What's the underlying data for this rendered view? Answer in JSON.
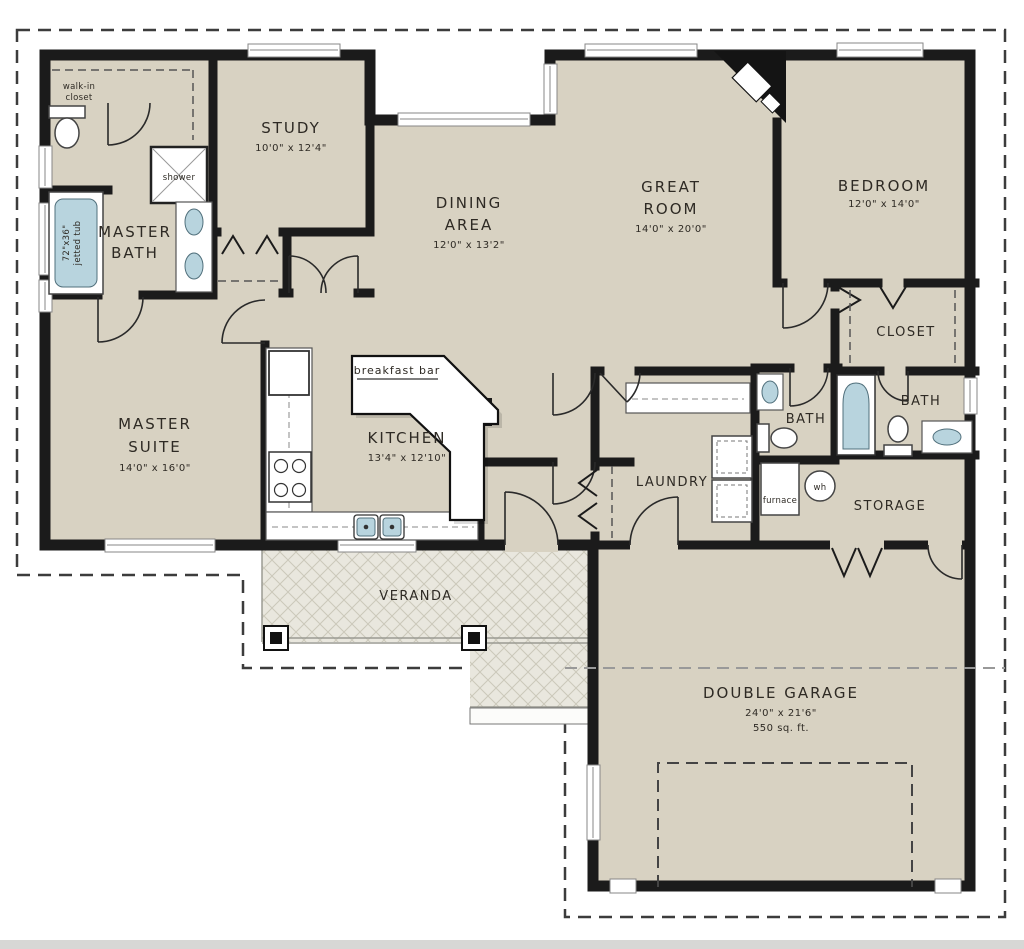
{
  "plan": {
    "title": "single-story house floor plan",
    "rooms": {
      "walk_in_closet": {
        "line1": "walk-in",
        "line2": "closet"
      },
      "master_bath": {
        "line1": "MASTER",
        "line2": "BATH"
      },
      "shower": {
        "label": "shower"
      },
      "jetted_tub": {
        "line1": "72\"x36\"",
        "line2": "jetted tub"
      },
      "study": {
        "name": "STUDY",
        "dims": "10'0\" x 12'4\""
      },
      "dining": {
        "line1": "DINING",
        "line2": "AREA",
        "dims": "12'0\" x 13'2\""
      },
      "great_room": {
        "line1": "GREAT",
        "line2": "ROOM",
        "dims": "14'0\" x 20'0\""
      },
      "bedroom": {
        "name": "BEDROOM",
        "dims": "12'0\" x 14'0\""
      },
      "closet": {
        "name": "CLOSET"
      },
      "master_suite": {
        "line1": "MASTER",
        "line2": "SUITE",
        "dims": "14'0\" x 16'0\""
      },
      "kitchen": {
        "name": "KITCHEN",
        "dims": "13'4\" x 12'10\""
      },
      "breakfast_bar": {
        "name": "breakfast bar"
      },
      "laundry": {
        "name": "LAUNDRY"
      },
      "bath_center": {
        "name": "BATH"
      },
      "bath_right": {
        "name": "BATH"
      },
      "furnace": {
        "name": "furnace"
      },
      "water_heater": {
        "name": "wh"
      },
      "storage": {
        "name": "STORAGE"
      },
      "veranda": {
        "name": "VERANDA"
      },
      "garage": {
        "name": "DOUBLE GARAGE",
        "dims": "24'0\" x 21'6\"",
        "area": "550 sq. ft."
      }
    },
    "colors": {
      "floor": "#d8d2c2",
      "wall": "#1b1b1b",
      "fixture_water": "#b8d4de",
      "veranda_floor": "#e9e7de"
    }
  }
}
